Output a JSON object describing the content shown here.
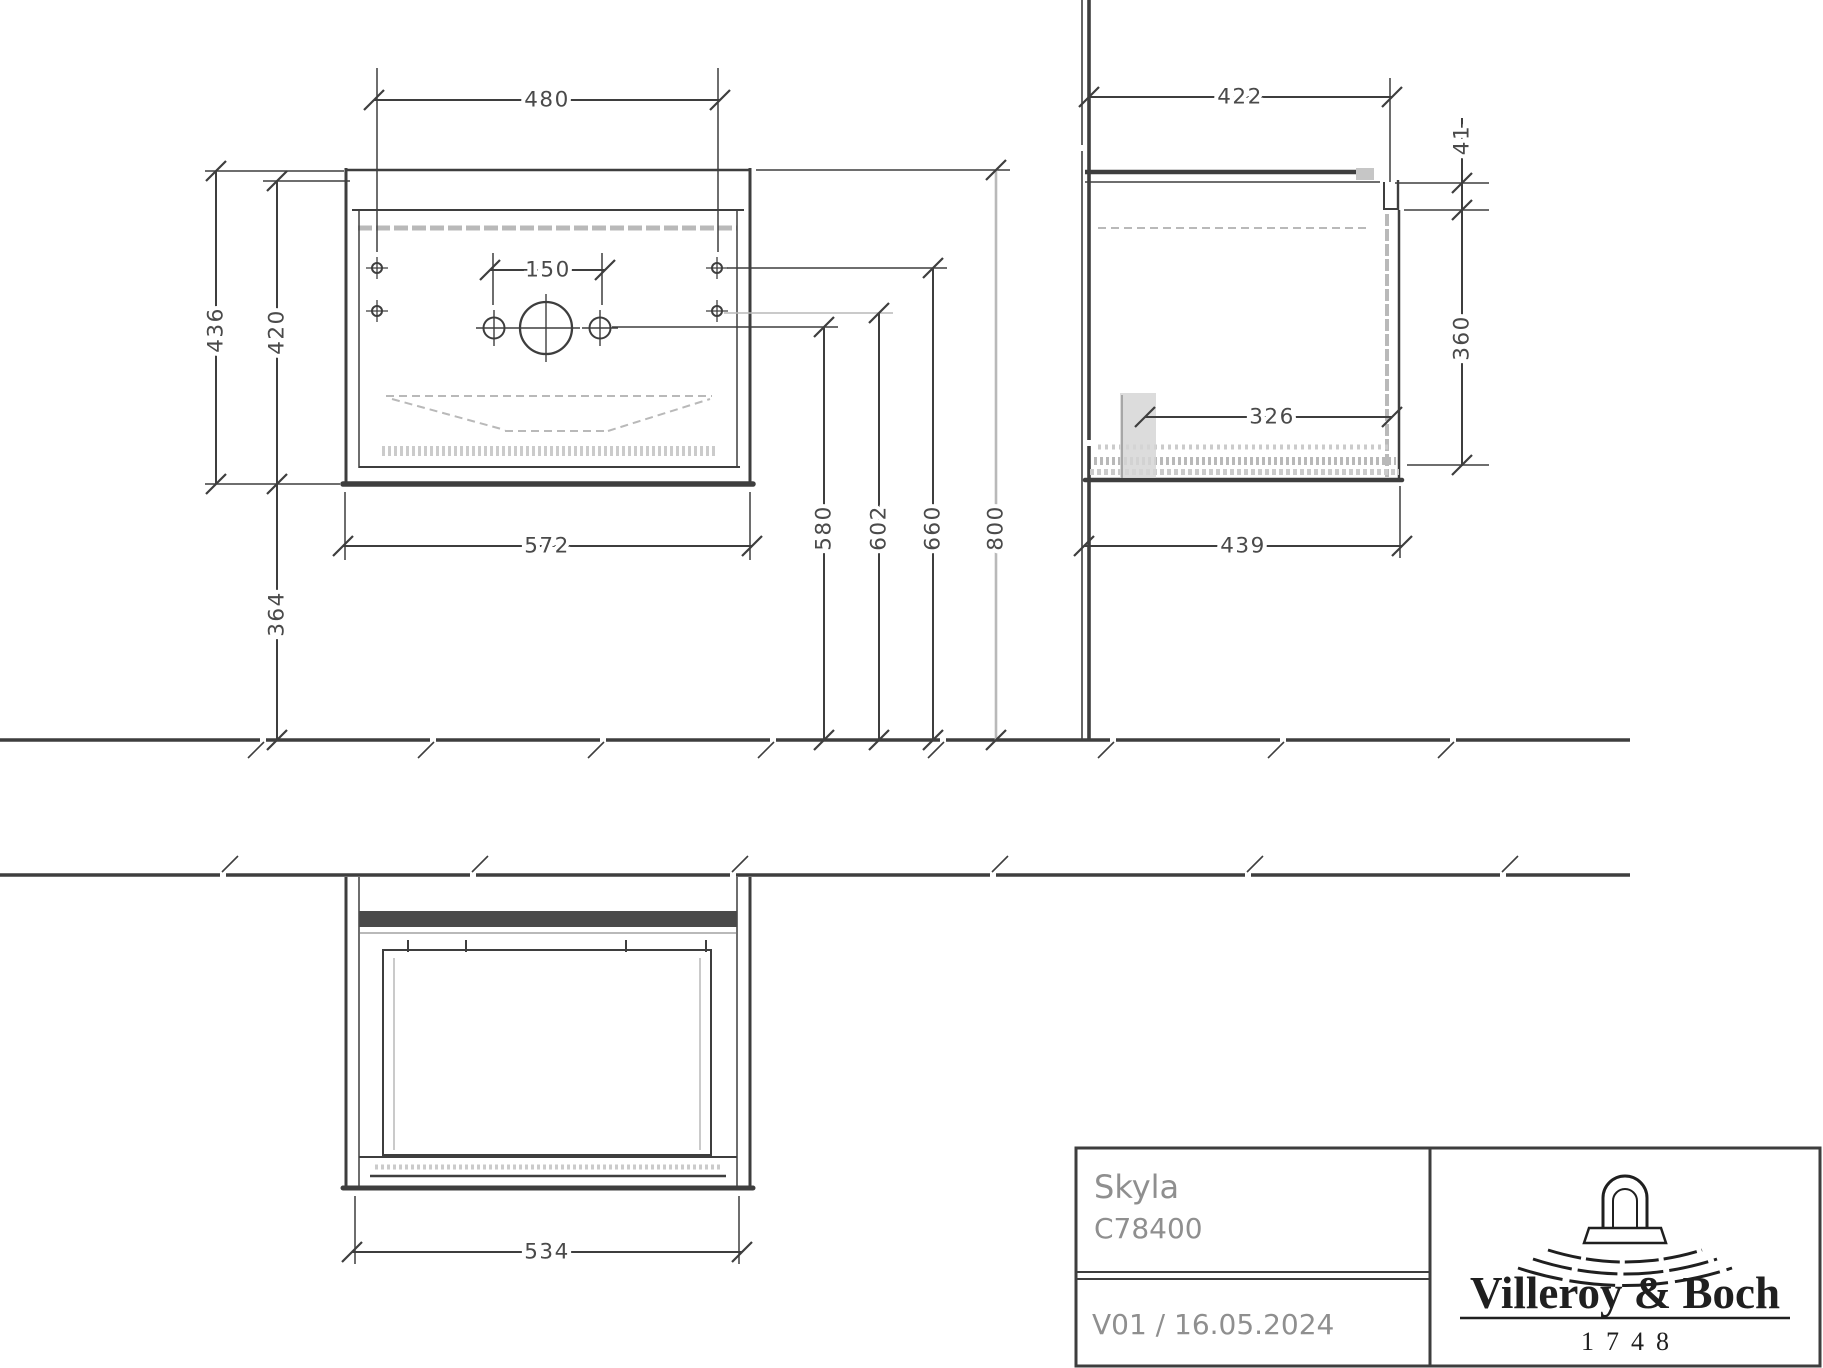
{
  "title_block": {
    "product_name": "Skyla",
    "article_number": "C78400",
    "version_date": "V01 / 16.05.2024",
    "brand_name": "Villeroy & Boch",
    "brand_year": "1748"
  },
  "dimensions": {
    "front": {
      "mounting_width": "480",
      "faucet_hole_spacing": "150",
      "total_height": "436",
      "cabinet_height": "420",
      "cabinet_width": "572",
      "floor_clearance": "364"
    },
    "heights": {
      "faucet_holes": "580",
      "lower_mounting_holes": "602",
      "upper_mounting_holes": "660",
      "basin_top": "800"
    },
    "side": {
      "wall_to_front": "422",
      "basin_edge_thickness": "41",
      "front_height": "360",
      "inner_depth": "326",
      "total_depth": "439"
    },
    "plan": {
      "body_width": "534"
    }
  },
  "colors": {
    "line_dark": "#3e3e3e",
    "line_light": "#b9b9b9",
    "dim_text": "#4a4a4a",
    "title_text": "#8f8f8f",
    "logo_dark": "#1f1f1f",
    "background": "#ffffff"
  }
}
